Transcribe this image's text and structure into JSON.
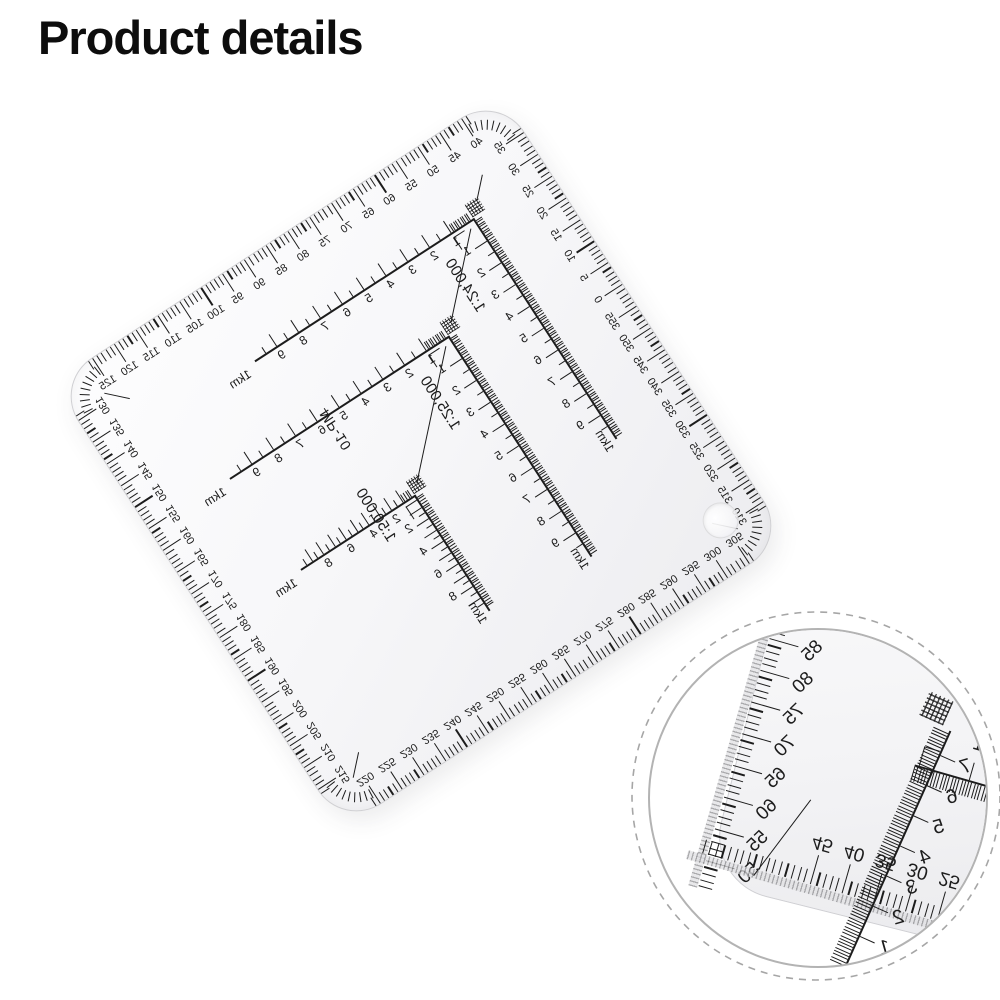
{
  "title": "Product details",
  "colors": {
    "ink": "#1c1c1c",
    "plastic_edge": "#cfcfd2",
    "inset_ring": "#b3b3b3",
    "inset_dash": "#a6a6a6"
  },
  "protractor": {
    "model": "MP-10",
    "edges": {
      "top": [
        "125",
        "120",
        "115",
        "110",
        "105",
        "100",
        "95",
        "90",
        "85",
        "80",
        "75",
        "70",
        "65",
        "60",
        "55",
        "50",
        "45",
        "40"
      ],
      "right": [
        "35",
        "30",
        "25",
        "20",
        "15",
        "10",
        "5",
        "0",
        "355",
        "350",
        "345",
        "340",
        "335",
        "330",
        "325",
        "320",
        "315",
        "310"
      ],
      "bottom": [
        "305",
        "300",
        "295",
        "290",
        "285",
        "280",
        "275",
        "270",
        "265",
        "260",
        "255",
        "250",
        "245",
        "240",
        "235",
        "230",
        "225",
        "220"
      ],
      "left": [
        "215",
        "210",
        "205",
        "200",
        "195",
        "190",
        "185",
        "180",
        "175",
        "170",
        "165",
        "160",
        "155",
        "150",
        "145",
        "140",
        "135",
        "130"
      ]
    }
  },
  "scales": [
    {
      "name": "1:24,000",
      "km": "1km",
      "step": 1,
      "numbers": [
        "1",
        "2",
        "3",
        "4",
        "5",
        "6",
        "7",
        "8",
        "9"
      ]
    },
    {
      "name": "1:25,000",
      "km": "1km",
      "step": 1,
      "numbers": [
        "1",
        "2",
        "3",
        "4",
        "5",
        "6",
        "7",
        "8",
        "9"
      ]
    },
    {
      "name": "1:50,000",
      "km": "1km",
      "step": 2,
      "numbers": [
        "2",
        "4",
        "6",
        "8"
      ]
    }
  ],
  "inset": {
    "edge_a": [
      "50",
      "55",
      "60",
      "65",
      "70",
      "75",
      "80",
      "85",
      "90",
      "95"
    ],
    "edge_b": [
      "10",
      "15",
      "20",
      "25",
      "30",
      "35",
      "40",
      "45"
    ],
    "arm": [
      "1",
      "2",
      "3",
      "4",
      "5",
      "6",
      "7"
    ],
    "arm2": [
      "1",
      "2",
      "3"
    ]
  }
}
